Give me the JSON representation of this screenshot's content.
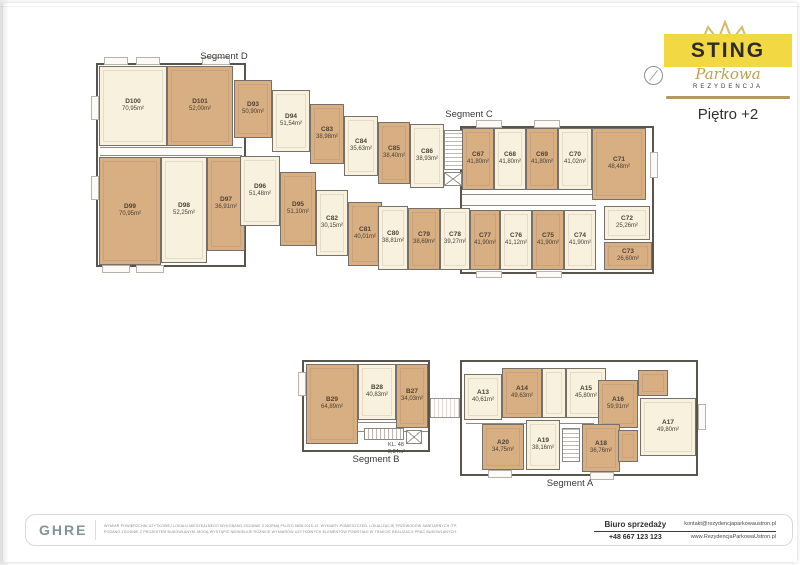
{
  "header": {
    "brand": "STING",
    "brand_script": "Parkowa",
    "brand_caps": "REZYDENCJA",
    "floor": "Piętro +2"
  },
  "colors": {
    "unit_highlight_tan": "#d8ae83",
    "unit_cream": "#f7f1dd",
    "logo_yellow": "#f2d843",
    "gold_accent": "#b39a62"
  },
  "plan": {
    "segment_a_label": "Segment A",
    "segment_b_label": "Segment B",
    "segment_c_label": "Segment C",
    "segment_d_label": "Segment D",
    "stair_label": "KL. 48",
    "stair_area": "2,34m²"
  },
  "units": {
    "D100": {
      "id": "D100",
      "area": "70,95m²"
    },
    "D101": {
      "id": "D101",
      "area": "52,00m²"
    },
    "D99": {
      "id": "D99",
      "area": "70,95m²"
    },
    "D98": {
      "id": "D98",
      "area": "52,25m²"
    },
    "D97": {
      "id": "D97",
      "area": "36,91m²"
    },
    "D96": {
      "id": "D96",
      "area": "51,48m²"
    },
    "D95": {
      "id": "D95",
      "area": "51,10m²"
    },
    "D94": {
      "id": "D94",
      "area": "51,54m²"
    },
    "D93": {
      "id": "D93",
      "area": "50,90m²"
    },
    "C83": {
      "id": "C83",
      "area": "38,98m²"
    },
    "C84": {
      "id": "C84",
      "area": "35,63m²"
    },
    "C85": {
      "id": "C85",
      "area": "38,40m²"
    },
    "C86": {
      "id": "C86",
      "area": "38,93m²"
    },
    "C82": {
      "id": "C82",
      "area": "30,15m²"
    },
    "C81": {
      "id": "C81",
      "area": "40,01m²"
    },
    "C80": {
      "id": "C80",
      "area": "38,81m²"
    },
    "C79": {
      "id": "C79",
      "area": "38,69m²"
    },
    "C78": {
      "id": "C78",
      "area": "39,27m²"
    },
    "C77": {
      "id": "C77",
      "area": "41,90m²"
    },
    "C76": {
      "id": "C76",
      "area": "41,12m²"
    },
    "C75": {
      "id": "C75",
      "area": "41,90m²"
    },
    "C74": {
      "id": "C74",
      "area": "41,90m²"
    },
    "C67": {
      "id": "C67",
      "area": "41,80m²"
    },
    "C68": {
      "id": "C68",
      "area": "41,80m²"
    },
    "C69": {
      "id": "C69",
      "area": "41,80m²"
    },
    "C70": {
      "id": "C70",
      "area": "41,02m²"
    },
    "C71": {
      "id": "C71",
      "area": "48,48m²"
    },
    "C72": {
      "id": "C72",
      "area": "25,26m²"
    },
    "C73": {
      "id": "C73",
      "area": "26,60m²"
    },
    "B29": {
      "id": "B29",
      "area": "64,89m²"
    },
    "B28": {
      "id": "B28",
      "area": "40,83m²"
    },
    "B27": {
      "id": "B27",
      "area": "34,03m²"
    },
    "A13": {
      "id": "A13",
      "area": "40,61m²"
    },
    "A14": {
      "id": "A14",
      "area": "49,63m²"
    },
    "A15": {
      "id": "A15",
      "area": "45,80m²"
    },
    "A16": {
      "id": "A16",
      "area": "59,91m²"
    },
    "A17": {
      "id": "A17",
      "area": "49,80m²"
    },
    "A20": {
      "id": "A20",
      "area": "34,75m²"
    },
    "A19": {
      "id": "A19",
      "area": "38,16m²"
    },
    "A18": {
      "id": "A18",
      "area": "36,76m²"
    }
  },
  "footer": {
    "agency": "GHRE",
    "disclaimer_line1": "WYMIAR POWIERZCHNI UŻYTKOWEJ LOKALU MIESZKALNEGO WYKONANO ZGODNIE Z NORMĄ PN-ISO 9836:2015-12. WYMIARY POMIESZCZEŃ, LOKALIZACJĘ PRZEWODÓW SANITARNYCH ITP.",
    "disclaimer_line2": "PODANO ZGODNIE Z PROJEKTEM BUDOWLANYM. MOGĄ WYSTĄPIĆ NIEWIELKIE RÓŻNICE WYMIARÓW UŻYTKOWYCH ELEMENTÓW POWSTAŁE W TRAKCIE REALIZACJI PRAC BUDOWLANYCH.",
    "sales_office_label": "Biuro sprzedaży",
    "phone": "+48 667 123 123",
    "email": "kontakt@rezydencjaparkowaustron.pl",
    "website": "www.RezydencjaParkowaUstron.pl"
  }
}
